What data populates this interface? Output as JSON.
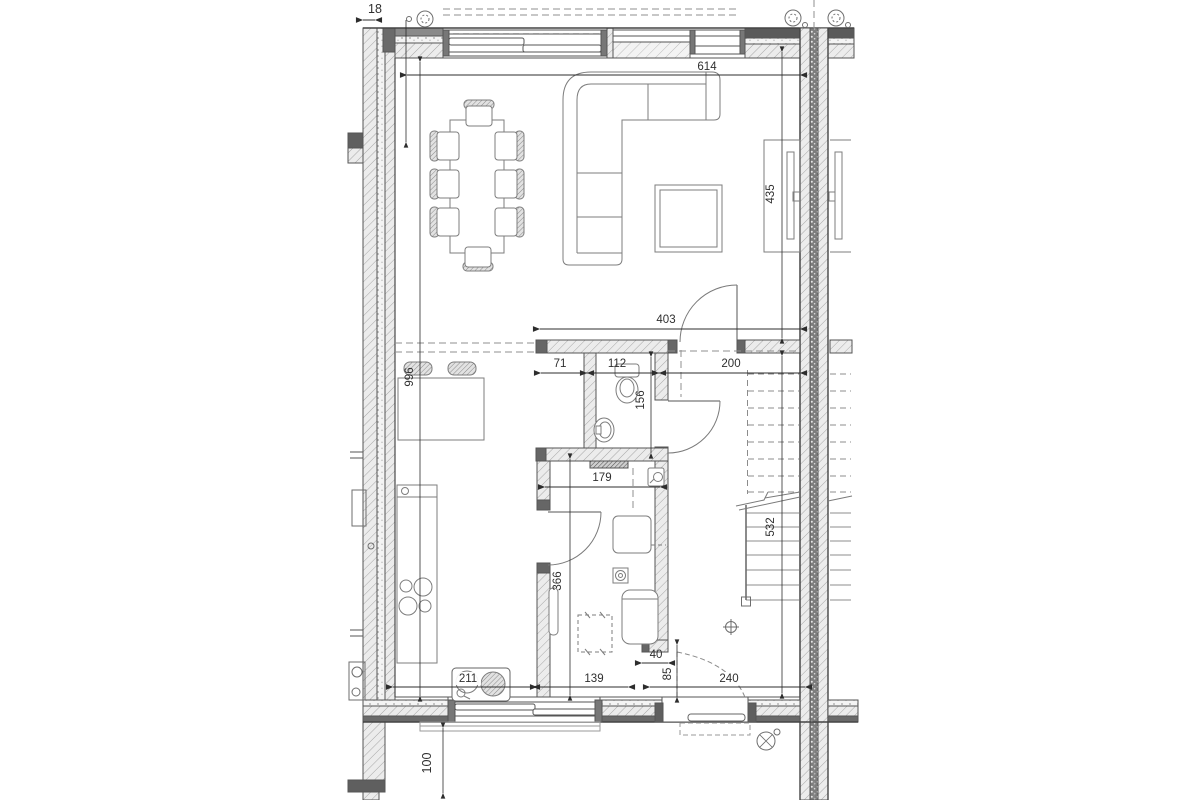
{
  "drawing": {
    "type": "architectural-floor-plan",
    "dims": {
      "wall_offset": "18",
      "total_depth": "996",
      "living_width": "614",
      "living_depth": "435",
      "hall_width": "403",
      "wc_offset": "71",
      "wc_width": "112",
      "stair_bay": "200",
      "wc_depth": "156",
      "tech_width": "179",
      "tech_depth": "366",
      "stair_run": "532",
      "kitchen_run": "211",
      "kitchen_window": "139",
      "wall_nib": "40",
      "entry_gap": "85",
      "entry_bay": "240",
      "stoop_depth": "100"
    },
    "symbols": {
      "rainwater_pipe": "circle-with-speckle",
      "floor_drain": "square-with-circle",
      "center_mark": "crosshair",
      "stair_break": "diagonal-cut-line"
    },
    "colors": {
      "line": "#4a4a4a",
      "wall_cap": "#5f5f5f",
      "hatch": "#a8a8a8",
      "furniture": "#7a7a7a",
      "paper": "#ffffff"
    }
  }
}
